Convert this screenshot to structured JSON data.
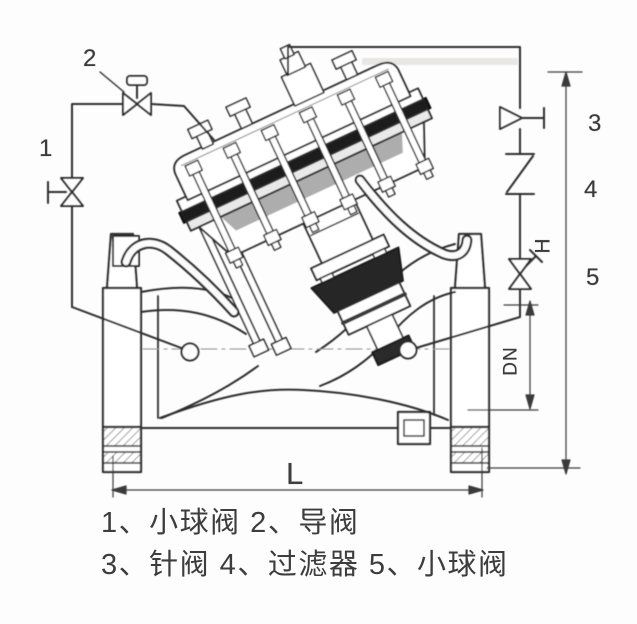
{
  "diagram": {
    "callouts": {
      "c1": "1",
      "c2": "2",
      "c3": "3",
      "c4": "4",
      "c5": "5"
    },
    "dimensions": {
      "height_label": "H",
      "diameter_label": "DN",
      "length_label": "L"
    },
    "caption": {
      "line1": "1、小球阀 2、导阀",
      "line2": "3、针阀 4、过滤器 5、小球阀"
    },
    "components": [
      {
        "id": "1",
        "name": "小球阀"
      },
      {
        "id": "2",
        "name": "导阀"
      },
      {
        "id": "3",
        "name": "针阀"
      },
      {
        "id": "4",
        "name": "过滤器"
      },
      {
        "id": "5",
        "name": "小球阀"
      }
    ],
    "colors": {
      "line": "#2d2d2d",
      "dark_fill": "#1c1c1c",
      "text": "#3d3d3d",
      "background": "#fdfdfd"
    }
  }
}
